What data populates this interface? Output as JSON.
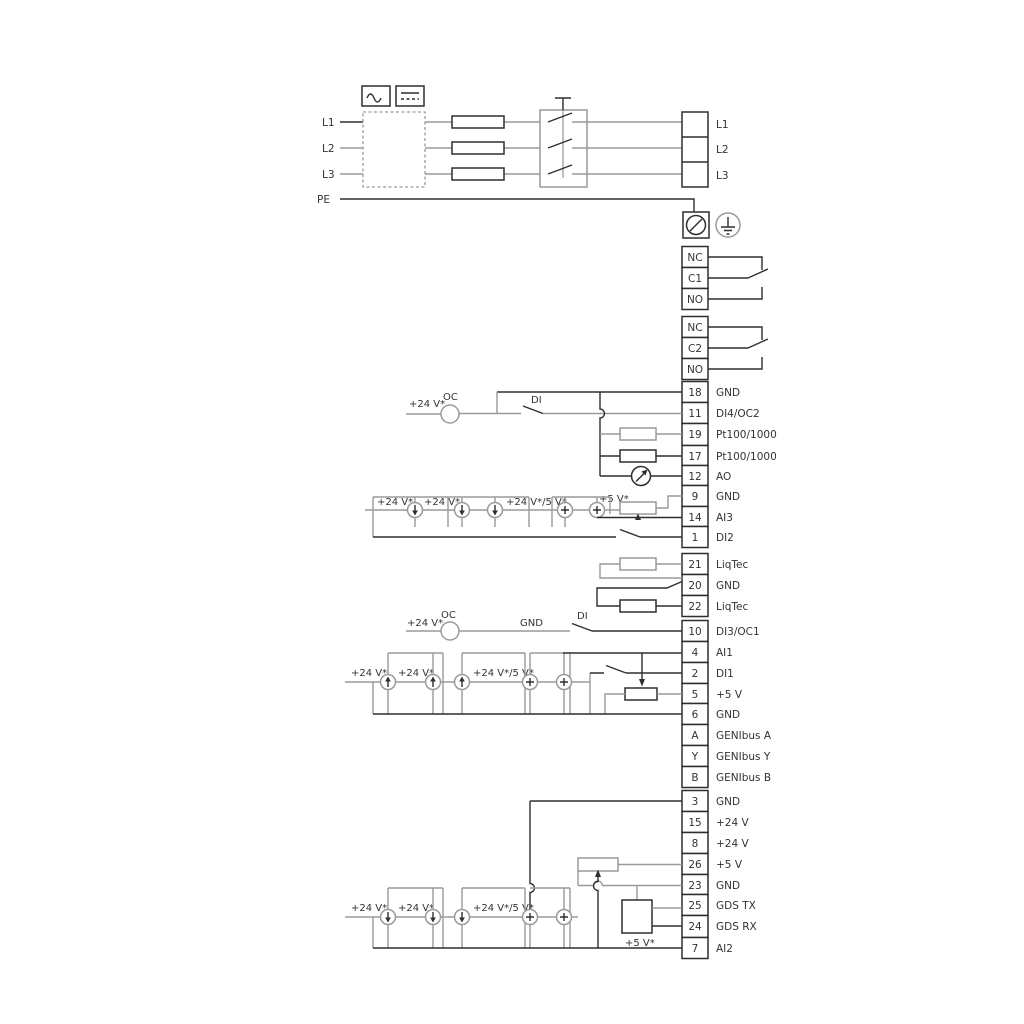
{
  "left_inputs": [
    "L1",
    "L2",
    "L3",
    "PE"
  ],
  "right_outputs": [
    "L1",
    "L2",
    "L3"
  ],
  "relay1": [
    "NC",
    "C1",
    "NO"
  ],
  "relay2": [
    "NC",
    "C2",
    "NO"
  ],
  "terminals": [
    {
      "num": "18",
      "label": "GND"
    },
    {
      "num": "11",
      "label": "DI4/OC2"
    },
    {
      "num": "19",
      "label": "Pt100/1000"
    },
    {
      "num": "17",
      "label": "Pt100/1000"
    },
    {
      "num": "12",
      "label": "AO"
    },
    {
      "num": "9",
      "label": "GND"
    },
    {
      "num": "14",
      "label": "AI3"
    },
    {
      "num": "1",
      "label": "DI2"
    },
    {
      "num": "21",
      "label": "LiqTec"
    },
    {
      "num": "20",
      "label": "GND"
    },
    {
      "num": "22",
      "label": "LiqTec"
    },
    {
      "num": "10",
      "label": "DI3/OC1"
    },
    {
      "num": "4",
      "label": "AI1"
    },
    {
      "num": "2",
      "label": "DI1"
    },
    {
      "num": "5",
      "label": "+5 V"
    },
    {
      "num": "6",
      "label": "GND"
    },
    {
      "num": "A",
      "label": "GENIbus A"
    },
    {
      "num": "Y",
      "label": "GENIbus Y"
    },
    {
      "num": "B",
      "label": "GENIbus B"
    },
    {
      "num": "3",
      "label": "GND"
    },
    {
      "num": "15",
      "label": "+24 V"
    },
    {
      "num": "8",
      "label": "+24 V"
    },
    {
      "num": "26",
      "label": "+5 V"
    },
    {
      "num": "23",
      "label": "GND"
    },
    {
      "num": "25",
      "label": "GDS TX"
    },
    {
      "num": "24",
      "label": "GDS RX"
    },
    {
      "num": "7",
      "label": "AI2"
    }
  ],
  "ann": [
    "+24 V*",
    "OC",
    "DI",
    "+24 V*",
    "+24 V*",
    "+24 V*/5 V*",
    "+5 V*",
    "+24 V*",
    "OC",
    "GND",
    "DI",
    "+24 V*",
    "+24 V*",
    "+24 V*/5 V*",
    "+24 V*",
    "+24 V*",
    "+24 V*/5 V*",
    "+5 V*"
  ],
  "colors": {
    "wire_gray": "#9a9a9a",
    "wire_dark": "#2e2e2e",
    "text": "#333333"
  }
}
